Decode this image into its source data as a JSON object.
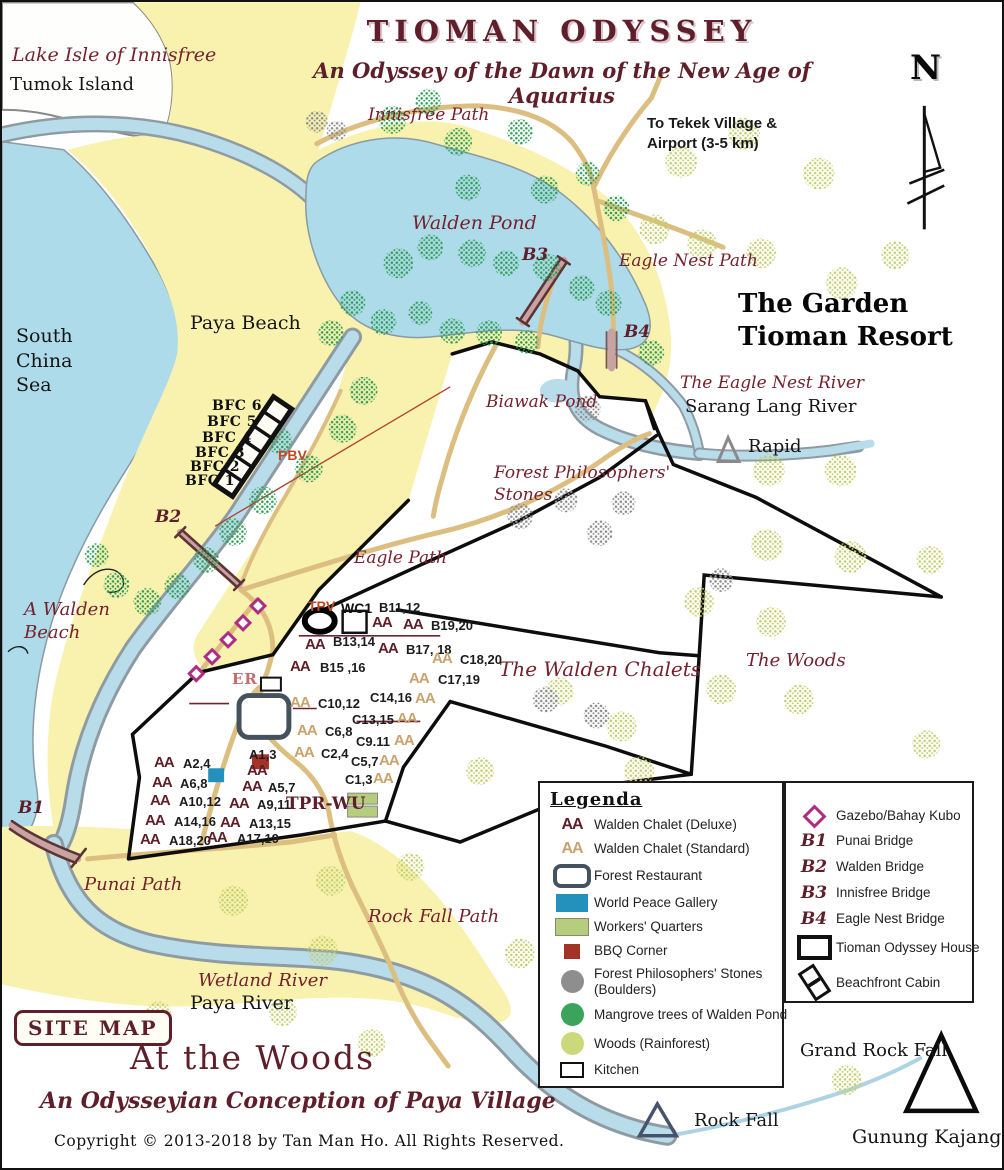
{
  "title": {
    "main": "TIOMAN ODYSSEY",
    "subtitle": "An Odyssey of the Dawn of the New Age of Aquarius"
  },
  "site_badge": "SITE MAP",
  "footer": {
    "heading": "At the Woods",
    "subheading": "An Odysseyian Conception of Paya Village",
    "copyright": "Copyright  ©  2013-2018   by Tan Man Ho.  All Rights Reserved."
  },
  "map_labels": [
    {
      "id": "lake-isle-of-innisfree",
      "text": "Lake Isle of Innisfree",
      "x": 10,
      "y": 42,
      "cls": "s19"
    },
    {
      "id": "tumok-island",
      "text": "Tumok Island",
      "x": 8,
      "y": 72,
      "cls": "r18"
    },
    {
      "id": "innisfree-path",
      "text": "Innisfree Path",
      "x": 366,
      "y": 103,
      "cls": "s17"
    },
    {
      "id": "to-tekek-village",
      "text": "To Tekek Village &\nAirport  (3-5 km)",
      "x": 645,
      "y": 112,
      "cls": "tekek"
    },
    {
      "id": "compass-n",
      "text": "N",
      "x": 908,
      "y": 46,
      "cls": "north"
    },
    {
      "id": "walden-pond",
      "text": "Walden Pond",
      "x": 410,
      "y": 210,
      "cls": "s19"
    },
    {
      "id": "bridge-b3",
      "text": "B3",
      "x": 520,
      "y": 243,
      "cls": "bridge"
    },
    {
      "id": "eagle-nest-path",
      "text": "Eagle Nest Path",
      "x": 617,
      "y": 249,
      "cls": "s17"
    },
    {
      "id": "garden-tioman-resort",
      "text": "The Garden\nTioman Resort",
      "x": 736,
      "y": 286,
      "cls": "resort"
    },
    {
      "id": "bridge-b4",
      "text": "B4",
      "x": 622,
      "y": 320,
      "cls": "bridge"
    },
    {
      "id": "south-china-sea",
      "text": "South\nChina\nSea",
      "x": 14,
      "y": 322,
      "cls": "r19 lh"
    },
    {
      "id": "paya-beach",
      "text": "Paya Beach",
      "x": 188,
      "y": 310,
      "cls": "r19"
    },
    {
      "id": "eagle-nest-river",
      "text": "The Eagle Nest River",
      "x": 678,
      "y": 371,
      "cls": "s17"
    },
    {
      "id": "sarang-lang-river",
      "text": "Sarang Lang River",
      "x": 683,
      "y": 394,
      "cls": "r18"
    },
    {
      "id": "biawak-pond",
      "text": "Biawak Pond",
      "x": 484,
      "y": 390,
      "cls": "s17"
    },
    {
      "id": "rapid",
      "text": "Rapid",
      "x": 746,
      "y": 434,
      "cls": "r18"
    },
    {
      "id": "forest-philosophers-stones",
      "text": "Forest Philosophers'\nStones",
      "x": 492,
      "y": 460,
      "cls": "s17 lh"
    },
    {
      "id": "bfc-6",
      "text": "BFC  6",
      "x": 210,
      "y": 396,
      "cls": "r14b"
    },
    {
      "id": "bfc-5",
      "text": "BFC  5",
      "x": 205,
      "y": 412,
      "cls": "r14b"
    },
    {
      "id": "bfc-4",
      "text": "BFC  4",
      "x": 200,
      "y": 428,
      "cls": "r14b"
    },
    {
      "id": "bfc-3",
      "text": "BFC  3",
      "x": 193,
      "y": 443,
      "cls": "r14b"
    },
    {
      "id": "bfc-2",
      "text": "BFC  2",
      "x": 188,
      "y": 457,
      "cls": "r14b"
    },
    {
      "id": "bfc-1",
      "text": "BFC  1",
      "x": 183,
      "y": 471,
      "cls": "r14b"
    },
    {
      "id": "pbv",
      "text": "PBV",
      "x": 276,
      "y": 445,
      "cls": "redb"
    },
    {
      "id": "bridge-b2",
      "text": "B2",
      "x": 153,
      "y": 505,
      "cls": "bridge"
    },
    {
      "id": "eagle-path",
      "text": "Eagle Path",
      "x": 352,
      "y": 546,
      "cls": "s17"
    },
    {
      "id": "a-walden-beach",
      "text": "A Walden\nBeach",
      "x": 22,
      "y": 596,
      "cls": "s18 lh"
    },
    {
      "id": "the-woods",
      "text": "The Woods",
      "x": 744,
      "y": 648,
      "cls": "s18"
    },
    {
      "id": "the-walden-chalets",
      "text": "The Walden Chalets",
      "x": 497,
      "y": 655,
      "cls": "s20"
    },
    {
      "id": "tpv",
      "text": "TPV",
      "x": 306,
      "y": 596,
      "cls": "redb"
    },
    {
      "id": "wc1",
      "text": "WC1",
      "x": 339,
      "y": 598,
      "cls": "wc1"
    },
    {
      "id": "er",
      "text": "ER",
      "x": 230,
      "y": 668,
      "cls": "er"
    },
    {
      "id": "tpr-wu",
      "text": "TPR-WU",
      "x": 284,
      "y": 792,
      "cls": "tpr"
    },
    {
      "id": "bridge-b1",
      "text": "B1",
      "x": 16,
      "y": 796,
      "cls": "bridge"
    },
    {
      "id": "punai-path",
      "text": "Punai Path",
      "x": 82,
      "y": 872,
      "cls": "s18"
    },
    {
      "id": "rock-fall-path",
      "text": "Rock Fall Path",
      "x": 366,
      "y": 904,
      "cls": "s18"
    },
    {
      "id": "wetland-river",
      "text": "Wetland River",
      "x": 196,
      "y": 968,
      "cls": "s18"
    },
    {
      "id": "paya-river",
      "text": "Paya River",
      "x": 188,
      "y": 990,
      "cls": "r19"
    },
    {
      "id": "grand-rock-fall",
      "text": "Grand Rock Fall",
      "x": 798,
      "y": 1038,
      "cls": "r18"
    },
    {
      "id": "rock-fall",
      "text": "Rock Fall",
      "x": 692,
      "y": 1108,
      "cls": "r18"
    },
    {
      "id": "gunung-kajang",
      "text": "Gunung Kajang",
      "x": 850,
      "y": 1124,
      "cls": "r19"
    }
  ],
  "chalets": {
    "deluxe_marker": "AA",
    "standard_marker": "AA",
    "markers": [
      {
        "type": "deluxe",
        "label": "B11,12",
        "x": 370,
        "y": 612,
        "lx": 377,
        "ly": 598
      },
      {
        "type": "deluxe",
        "label": "B19,20",
        "x": 401,
        "y": 614,
        "lx": 429,
        "ly": 616
      },
      {
        "type": "deluxe",
        "label": "B13,14",
        "x": 303,
        "y": 634,
        "lx": 331,
        "ly": 632
      },
      {
        "type": "deluxe",
        "label": "B17, 18",
        "x": 376,
        "y": 638,
        "lx": 404,
        "ly": 640
      },
      {
        "type": "deluxe",
        "label": "B15 ,16",
        "x": 288,
        "y": 656,
        "lx": 318,
        "ly": 658
      },
      {
        "type": "standard",
        "label": "C18,20",
        "x": 430,
        "y": 648,
        "lx": 458,
        "ly": 650
      },
      {
        "type": "standard",
        "label": "C17,19",
        "x": 407,
        "y": 668,
        "lx": 436,
        "ly": 670
      },
      {
        "type": "standard",
        "label": "C10,12",
        "x": 288,
        "y": 692,
        "lx": 316,
        "ly": 694
      },
      {
        "type": "standard",
        "label": "C14,16",
        "x": 413,
        "y": 688,
        "lx": 368,
        "ly": 688
      },
      {
        "type": "standard",
        "label": "C13,15",
        "x": 395,
        "y": 708,
        "lx": 350,
        "ly": 710
      },
      {
        "type": "standard",
        "label": "C6,8",
        "x": 295,
        "y": 720,
        "lx": 323,
        "ly": 722
      },
      {
        "type": "standard",
        "label": "C9.11",
        "x": 392,
        "y": 730,
        "lx": 354,
        "ly": 732
      },
      {
        "type": "standard",
        "label": "C2,4",
        "x": 292,
        "y": 742,
        "lx": 319,
        "ly": 744
      },
      {
        "type": "standard",
        "label": "C5,7",
        "x": 377,
        "y": 750,
        "lx": 349,
        "ly": 752
      },
      {
        "type": "standard",
        "label": "C1,3",
        "x": 371,
        "y": 768,
        "lx": 343,
        "ly": 770
      },
      {
        "type": "deluxe",
        "label": "A2,4",
        "x": 152,
        "y": 752,
        "lx": 181,
        "ly": 754
      },
      {
        "type": "deluxe",
        "label": "A1,3",
        "x": 245,
        "y": 760,
        "lx": 247,
        "ly": 745
      },
      {
        "type": "deluxe",
        "label": "A6,8",
        "x": 150,
        "y": 772,
        "lx": 178,
        "ly": 774
      },
      {
        "type": "deluxe",
        "label": "A5,7",
        "x": 240,
        "y": 776,
        "lx": 266,
        "ly": 778
      },
      {
        "type": "deluxe",
        "label": "A10,12",
        "x": 148,
        "y": 790,
        "lx": 177,
        "ly": 792
      },
      {
        "type": "deluxe",
        "label": "A9,11",
        "x": 227,
        "y": 793,
        "lx": 255,
        "ly": 795
      },
      {
        "type": "deluxe",
        "label": "A14,16",
        "x": 143,
        "y": 810,
        "lx": 172,
        "ly": 812
      },
      {
        "type": "deluxe",
        "label": "A13,15",
        "x": 218,
        "y": 812,
        "lx": 247,
        "ly": 814
      },
      {
        "type": "deluxe",
        "label": "A18,20",
        "x": 138,
        "y": 829,
        "lx": 167,
        "ly": 831
      },
      {
        "type": "deluxe",
        "label": "A17,19",
        "x": 205,
        "y": 827,
        "lx": 235,
        "ly": 829
      }
    ]
  },
  "legend_left": {
    "heading": "Legenda",
    "items": [
      {
        "icon": "deluxe-chalet",
        "marker": "AA",
        "label": "Walden Chalet (Deluxe)"
      },
      {
        "icon": "standard-chalet",
        "marker": "AA",
        "label": "Walden Chalet (Standard)"
      },
      {
        "icon": "forest-restaurant",
        "label": "Forest Restaurant"
      },
      {
        "icon": "world-peace-gallery",
        "label": "World Peace Gallery"
      },
      {
        "icon": "workers-quarters",
        "label": "Workers' Quarters"
      },
      {
        "icon": "bbq-corner",
        "label": "BBQ Corner"
      },
      {
        "icon": "boulder",
        "label": "Forest Philosophers' Stones (Boulders)",
        "wrap": true
      },
      {
        "icon": "mangrove",
        "label": "Mangrove trees of Walden Pond"
      },
      {
        "icon": "woods",
        "label": "Woods (Rainforest)"
      },
      {
        "icon": "kitchen",
        "label": "Kitchen"
      }
    ]
  },
  "legend_right": {
    "items": [
      {
        "icon": "gazebo",
        "label": "Gazebo/Bahay Kubo"
      },
      {
        "key": "B1",
        "label": "Punai Bridge"
      },
      {
        "key": "B2",
        "label": "Walden Bridge"
      },
      {
        "key": "B3",
        "label": "Innisfree Bridge"
      },
      {
        "key": "B4",
        "label": "Eagle Nest Bridge"
      },
      {
        "icon": "odyssey-house",
        "label": "Tioman Odyssey House"
      },
      {
        "icon": "beachfront-cabin",
        "label": "Beachfront Cabin"
      }
    ]
  }
}
